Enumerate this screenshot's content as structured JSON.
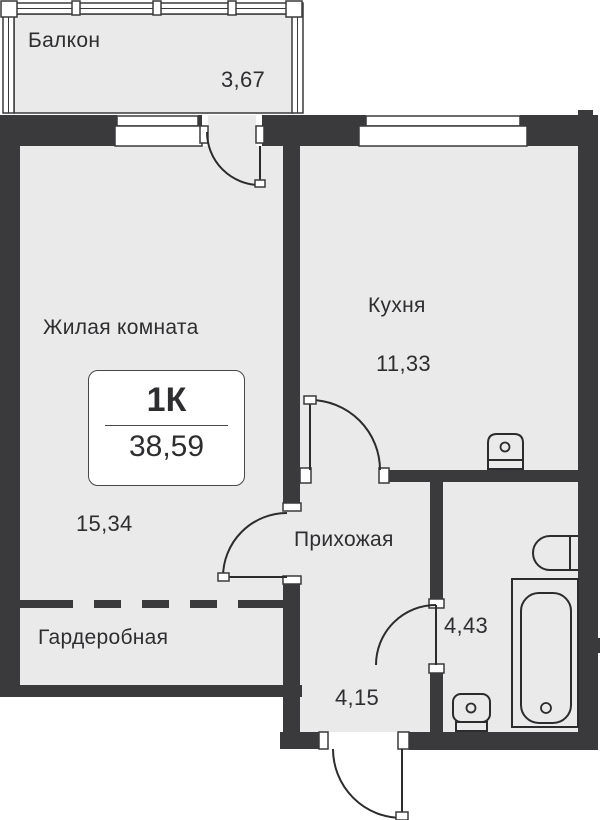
{
  "plan": {
    "unit_card": {
      "rooms_label": "1К",
      "total_area": "38,59"
    },
    "rooms": {
      "balcony": {
        "label": "Балкон",
        "area": "3,67"
      },
      "living_room": {
        "label": "Жилая комната",
        "area": "15,34"
      },
      "kitchen": {
        "label": "Кухня",
        "area": "11,33"
      },
      "hallway": {
        "label": "Прихожая",
        "area": "4,15"
      },
      "bathroom": {
        "area": "4,43"
      },
      "wardrobe": {
        "label": "Гардеробная"
      }
    },
    "colors": {
      "wall": "#3a3a3c",
      "floor": "#eaeaeb",
      "outline": "#2c2c2e",
      "text": "#2e2e30"
    }
  }
}
